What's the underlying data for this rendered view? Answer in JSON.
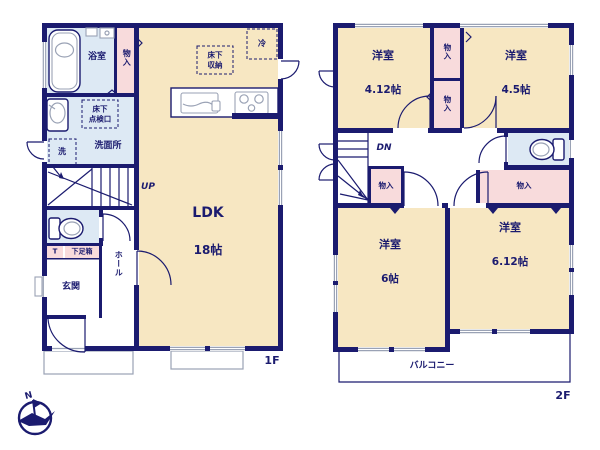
{
  "colors": {
    "wall": "#1b1b6f",
    "cream": "#f7e7c2",
    "blue": "#dde9f4",
    "pink": "#f8dbdc",
    "gray": "#9aa2b5",
    "white": "#ffffff"
  },
  "floor1": {
    "floor_label": "1F",
    "ldk": {
      "name": "LDK",
      "size": "18帖"
    },
    "bathroom": "浴室",
    "closet": "物入",
    "underfloor_hatch": "床下\n点検口",
    "washer": "洗",
    "washroom": "洗面所",
    "stairs_up": "UP",
    "fridge": "冷",
    "underfloor_storage": "床下\n収納",
    "shoe_t": "T",
    "shoe_box": "下足箱",
    "entrance": "玄関",
    "hall": "ホール"
  },
  "floor2": {
    "floor_label": "2F",
    "room_nw": {
      "name": "洋室",
      "size": "4.12帖"
    },
    "room_ne": {
      "name": "洋室",
      "size": "4.5帖"
    },
    "room_sw": {
      "name": "洋室",
      "size": "6帖"
    },
    "room_se": {
      "name": "洋室",
      "size": "6.12帖"
    },
    "closet_upper": "物入",
    "closet_lower": "物入",
    "closet_hall": "物入",
    "closet_wide": "物入",
    "stairs_down": "DN",
    "balcony": "バルコニー"
  },
  "compass": {
    "north_label": "N"
  }
}
